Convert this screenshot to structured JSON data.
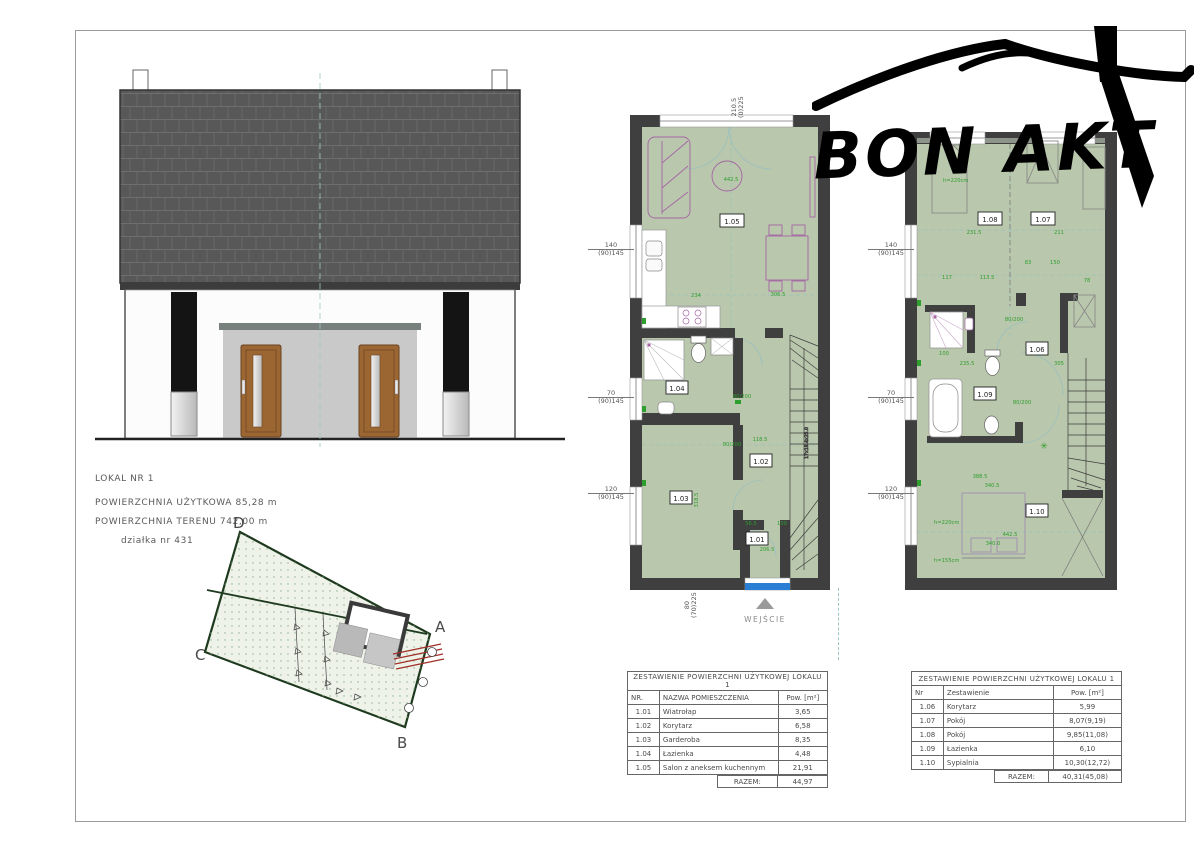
{
  "info_block": {
    "line1": "LOKAL NR 1",
    "line2": "POWIERZCHNIA UŻYTKOWA 85,28 m",
    "line3": "POWIERZCHNIA TERENU 742,00 m",
    "line4": "działka nr 431"
  },
  "logo": {
    "text": "BON AKT"
  },
  "site_plan": {
    "corner_a": "A",
    "corner_b": "B",
    "corner_c": "C",
    "corner_d": "D"
  },
  "gf": {
    "rooms": {
      "r101": "1.01",
      "r102": "1.02",
      "r103": "1.03",
      "r104": "1.04",
      "r105": "1.05"
    },
    "entrance": "WEJŚCIE",
    "dims": {
      "win1_a": "140",
      "win1_b": "(90)145",
      "win2_a": "70",
      "win2_b": "(90)145",
      "win3_a": "120",
      "win3_b": "(90)145",
      "top_a": "210.5",
      "top_b": "(0)225",
      "door_a": "80",
      "door_b": "(70)225",
      "d442": "442.5",
      "d234": "234",
      "d306": "306.5",
      "d80200": "80/200",
      "d118": "118.5",
      "d318": "318.5",
      "d56": "56.5",
      "d100": "100",
      "d206": "206.5",
      "stairs": "17x18.4x25.0"
    }
  },
  "uf": {
    "rooms": {
      "r106": "1.06",
      "r107": "1.07",
      "r108": "1.08",
      "r109": "1.09",
      "r110": "1.10"
    },
    "dims": {
      "win1_a": "140",
      "win1_b": "(90)145",
      "win2_a": "70",
      "win2_b": "(90)145",
      "win3_a": "120",
      "win3_b": "(90)145",
      "d231": "231.5",
      "d211": "211",
      "d117": "117",
      "d113": "113.5",
      "d83": "83",
      "d150": "150",
      "d78": "78",
      "d80200a": "80/200",
      "d80200b": "80/200",
      "d235": "235.5",
      "d100": "100",
      "d305": "305",
      "d388": "388.5",
      "d340a": "340.5",
      "d442": "442.5",
      "d340b": "340.0",
      "h220a": "h=220cm",
      "h220b": "h=220cm",
      "h155": "h=155cm"
    }
  },
  "tables": [
    {
      "title": "ZESTAWIENIE POWIERZCHNI UŻYTKOWEJ LOKALU 1",
      "headers": [
        "NR.",
        "NAZWA POMIESZCZENIA",
        "Pow. [m²]"
      ],
      "rows": [
        [
          "1.01",
          "Wiatrołap",
          "3,65"
        ],
        [
          "1.02",
          "Korytarz",
          "6,58"
        ],
        [
          "1.03",
          "Garderoba",
          "8,35"
        ],
        [
          "1.04",
          "Łazienka",
          "4,48"
        ],
        [
          "1.05",
          "Salon z aneksem kuchennym",
          "21,91"
        ]
      ],
      "total_label": "RAZEM:",
      "total": "44,97"
    },
    {
      "title": "ZESTAWIENIE POWIERZCHNI UŻYTKOWEJ LOKALU 1",
      "headers": [
        "Nr",
        "Zestawienie",
        "Pow. [m²]"
      ],
      "rows": [
        [
          "1.06",
          "Korytarz",
          "5,99"
        ],
        [
          "1.07",
          "Pokój",
          "8,07(9,19)"
        ],
        [
          "1.08",
          "Pokój",
          "9,85(11,08)"
        ],
        [
          "1.09",
          "Łazienka",
          "6,10"
        ],
        [
          "1.10",
          "Sypialnia",
          "10,30(12,72)"
        ]
      ],
      "total_label": "RAZEM:",
      "total": "40,31(45,08)"
    }
  ],
  "colors": {
    "plan_fill": "#b9c7ac",
    "wall": "#3f3f3f",
    "dim_green": "#2e9e2e",
    "furniture_magenta": "#a565a5",
    "entrance_blue": "#2a7fd4",
    "door_brown": "#9c6633",
    "roof_gray": "#585858"
  }
}
